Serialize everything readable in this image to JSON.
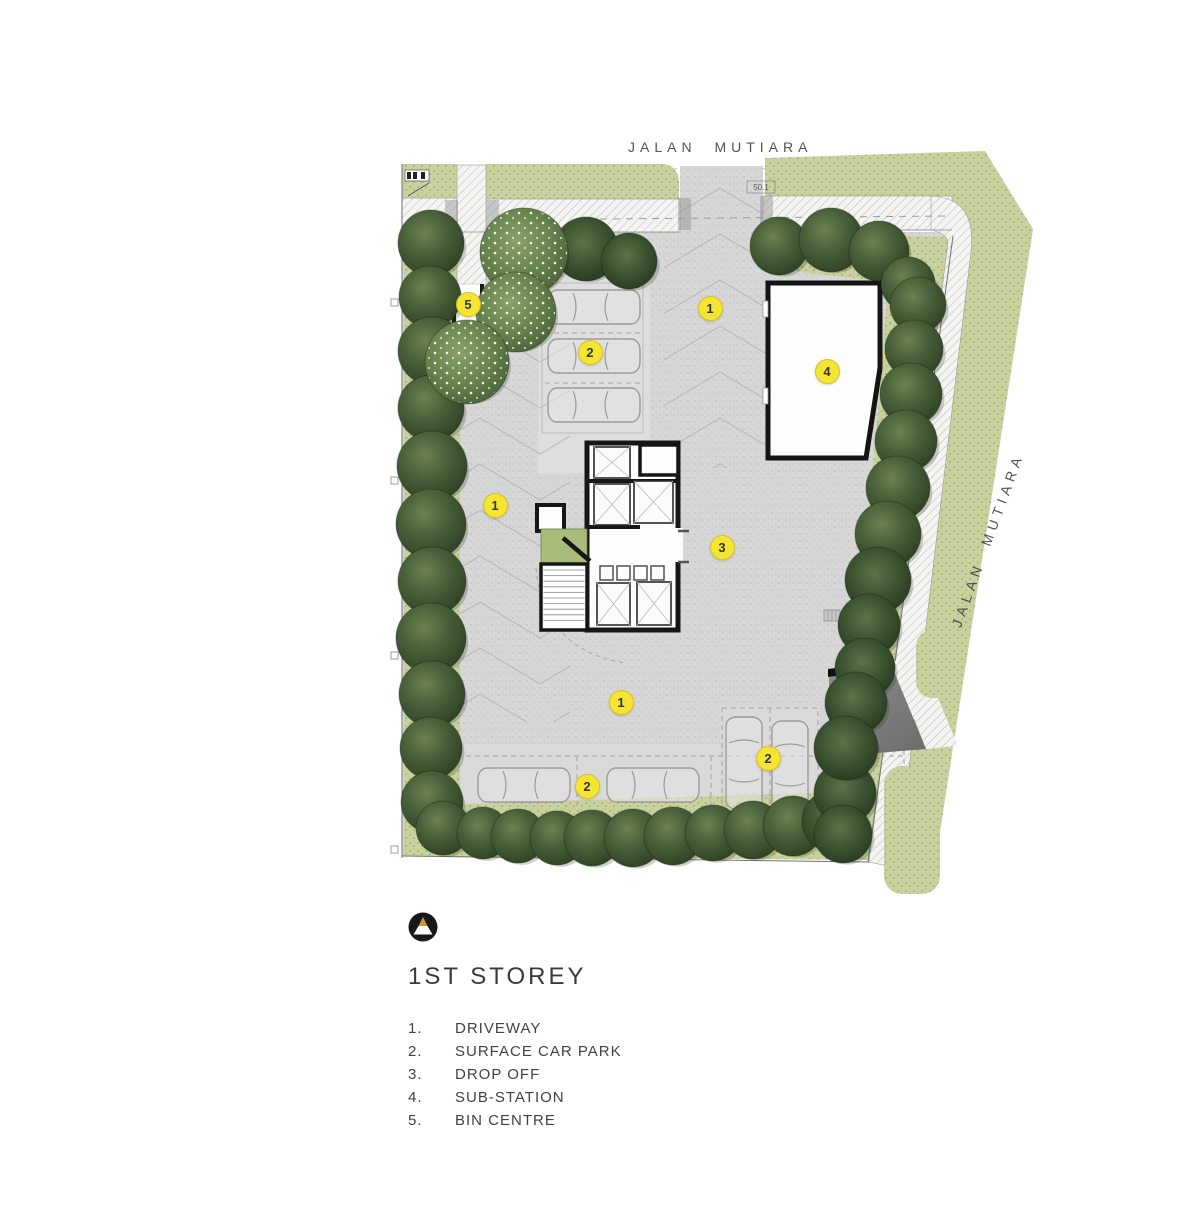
{
  "roads": {
    "top_label": "JALAN MUTIARA",
    "side_label": "JALAN MUTIARA"
  },
  "legend": {
    "title": "1ST STOREY",
    "items": [
      {
        "num": "1.",
        "label": "DRIVEWAY"
      },
      {
        "num": "2.",
        "label": "SURFACE CAR PARK"
      },
      {
        "num": "3.",
        "label": "DROP OFF"
      },
      {
        "num": "4.",
        "label": "SUB-STATION"
      },
      {
        "num": "5.",
        "label": "BIN CENTRE"
      }
    ]
  },
  "annotations": {
    "gate_dimension": "50.1"
  },
  "markers": [
    {
      "label": "5",
      "x": 468,
      "y": 304
    },
    {
      "label": "2",
      "x": 590,
      "y": 352
    },
    {
      "label": "1",
      "x": 710,
      "y": 308
    },
    {
      "label": "4",
      "x": 827,
      "y": 371
    },
    {
      "label": "1",
      "x": 495,
      "y": 505
    },
    {
      "label": "3",
      "x": 722,
      "y": 547
    },
    {
      "label": "1",
      "x": 621,
      "y": 702
    },
    {
      "label": "2",
      "x": 587,
      "y": 786
    },
    {
      "label": "2",
      "x": 768,
      "y": 758
    }
  ],
  "trees": [
    {
      "x": 431,
      "y": 243,
      "r": 33,
      "t": "dark"
    },
    {
      "x": 430,
      "y": 297,
      "r": 31,
      "t": "dark"
    },
    {
      "x": 432,
      "y": 351,
      "r": 34,
      "t": "dark"
    },
    {
      "x": 431,
      "y": 408,
      "r": 33,
      "t": "dark"
    },
    {
      "x": 432,
      "y": 466,
      "r": 35,
      "t": "dark"
    },
    {
      "x": 431,
      "y": 524,
      "r": 35,
      "t": "dark"
    },
    {
      "x": 432,
      "y": 581,
      "r": 34,
      "t": "dark"
    },
    {
      "x": 431,
      "y": 638,
      "r": 35,
      "t": "dark"
    },
    {
      "x": 432,
      "y": 694,
      "r": 33,
      "t": "dark"
    },
    {
      "x": 431,
      "y": 748,
      "r": 31,
      "t": "dark"
    },
    {
      "x": 432,
      "y": 802,
      "r": 31,
      "t": "dark"
    },
    {
      "x": 443,
      "y": 828,
      "r": 27,
      "t": "dark"
    },
    {
      "x": 483,
      "y": 833,
      "r": 26,
      "t": "dark"
    },
    {
      "x": 518,
      "y": 836,
      "r": 27,
      "t": "dark"
    },
    {
      "x": 557,
      "y": 838,
      "r": 27,
      "t": "dark"
    },
    {
      "x": 592,
      "y": 838,
      "r": 28,
      "t": "dark"
    },
    {
      "x": 633,
      "y": 838,
      "r": 29,
      "t": "dark"
    },
    {
      "x": 673,
      "y": 836,
      "r": 29,
      "t": "dark"
    },
    {
      "x": 713,
      "y": 833,
      "r": 28,
      "t": "dark"
    },
    {
      "x": 753,
      "y": 830,
      "r": 29,
      "t": "dark"
    },
    {
      "x": 793,
      "y": 826,
      "r": 30,
      "t": "dark"
    },
    {
      "x": 833,
      "y": 821,
      "r": 31,
      "t": "spiky"
    },
    {
      "x": 845,
      "y": 793,
      "r": 31,
      "t": "spiky"
    },
    {
      "x": 843,
      "y": 834,
      "r": 29,
      "t": "spiky"
    },
    {
      "x": 586,
      "y": 249,
      "r": 32,
      "t": "spiky"
    },
    {
      "x": 629,
      "y": 261,
      "r": 28,
      "t": "spiky"
    },
    {
      "x": 524,
      "y": 252,
      "r": 44,
      "t": "flower"
    },
    {
      "x": 516,
      "y": 312,
      "r": 40,
      "t": "flower"
    },
    {
      "x": 467,
      "y": 362,
      "r": 42,
      "t": "flower"
    },
    {
      "x": 779,
      "y": 246,
      "r": 29,
      "t": "dark"
    },
    {
      "x": 831,
      "y": 240,
      "r": 32,
      "t": "dark"
    },
    {
      "x": 879,
      "y": 251,
      "r": 30,
      "t": "dark"
    },
    {
      "x": 908,
      "y": 284,
      "r": 27,
      "t": "dark"
    },
    {
      "x": 918,
      "y": 305,
      "r": 28,
      "t": "dark"
    },
    {
      "x": 914,
      "y": 349,
      "r": 29,
      "t": "dark"
    },
    {
      "x": 911,
      "y": 394,
      "r": 31,
      "t": "dark"
    },
    {
      "x": 906,
      "y": 441,
      "r": 31,
      "t": "dark"
    },
    {
      "x": 898,
      "y": 488,
      "r": 32,
      "t": "dark"
    },
    {
      "x": 888,
      "y": 534,
      "r": 33,
      "t": "dark"
    },
    {
      "x": 878,
      "y": 580,
      "r": 33,
      "t": "spiky"
    },
    {
      "x": 869,
      "y": 625,
      "r": 31,
      "t": "spiky"
    },
    {
      "x": 865,
      "y": 668,
      "r": 30,
      "t": "spiky"
    },
    {
      "x": 856,
      "y": 703,
      "r": 31,
      "t": "spiky"
    },
    {
      "x": 846,
      "y": 748,
      "r": 32,
      "t": "spiky"
    }
  ],
  "cars": [
    {
      "x": 548,
      "y": 290,
      "o": "h"
    },
    {
      "x": 548,
      "y": 339,
      "o": "h"
    },
    {
      "x": 548,
      "y": 388,
      "o": "h"
    },
    {
      "x": 478,
      "y": 768,
      "o": "h"
    },
    {
      "x": 607,
      "y": 768,
      "o": "h"
    },
    {
      "x": 726,
      "y": 717,
      "o": "v"
    },
    {
      "x": 772,
      "y": 721,
      "o": "v"
    }
  ],
  "colors": {
    "marker_yellow": "#f5e533",
    "site_gray": "#d7d7d7",
    "verge_green": "#c9d19f",
    "tree_dark": "#42522f",
    "building_wall": "#161616",
    "logo_gold": "#c9992f",
    "text": "#3e3e3e"
  }
}
